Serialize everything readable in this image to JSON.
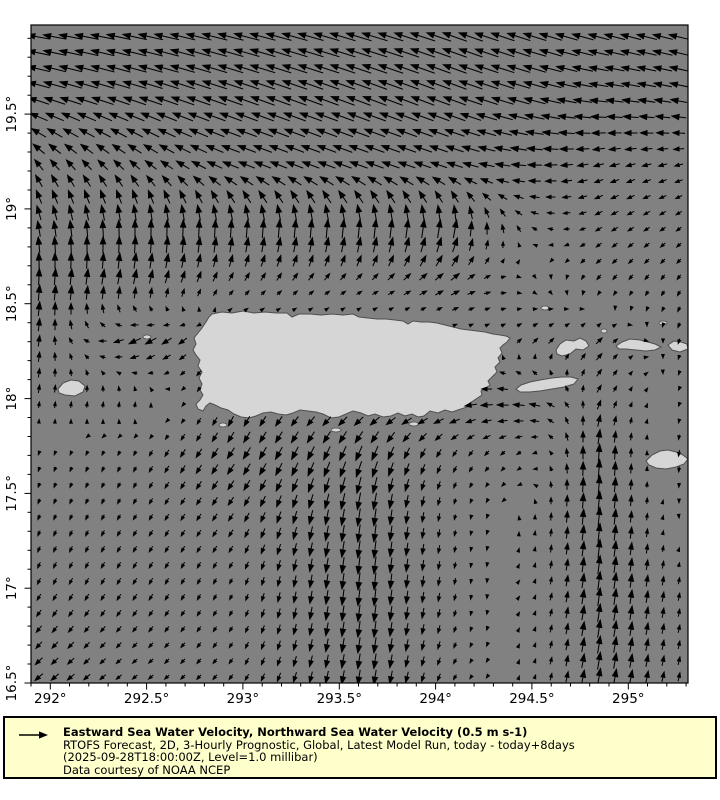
{
  "chart_data": {
    "type": "quiver",
    "description": "Gridded sea-water velocity vector field over Puerto Rico and surrounding Caribbean waters",
    "x_axis": {
      "range": [
        291.9,
        295.31
      ],
      "minor_step": 0.1,
      "major": [
        {
          "label": "292°",
          "value": 292.0
        },
        {
          "label": "292.5°",
          "value": 292.5
        },
        {
          "label": "293°",
          "value": 293.0
        },
        {
          "label": "293.5°",
          "value": 293.5
        },
        {
          "label": "294°",
          "value": 294.0
        },
        {
          "label": "294.5°",
          "value": 294.5
        },
        {
          "label": "295°",
          "value": 295.0
        }
      ]
    },
    "y_axis": {
      "range": [
        16.5,
        19.97
      ],
      "minor_step": 0.1,
      "major": [
        {
          "label": "19.5°",
          "value": 19.5
        },
        {
          "label": "19°",
          "value": 19.0
        },
        {
          "label": "18.5°",
          "value": 18.5
        },
        {
          "label": "18°",
          "value": 18.0
        },
        {
          "label": "17.5°",
          "value": 17.5
        },
        {
          "label": "17°",
          "value": 17.0
        },
        {
          "label": "16.5°",
          "value": 16.5
        }
      ]
    },
    "reference_vector": {
      "speed": 0.5,
      "units": "m s-1"
    },
    "plot_rect": {
      "left": 31,
      "top": 25,
      "right": 688,
      "bottom": 683
    },
    "arrow_grid": {
      "x0": 39,
      "y0": 37,
      "step": 16,
      "cols": 41,
      "rows": 41,
      "px_per_ms": 60
    },
    "colors": {
      "ocean": "#818181",
      "land": "#d6d6d6",
      "coastline": "#4f4f4f",
      "arrow": "#000000",
      "frame": "#000000",
      "legend_bg": "#ffffcc",
      "legend_border": "#000000",
      "page_bg": "#ffffff"
    },
    "field": {
      "units": "m s-1",
      "lons": [
        291.9,
        292.45,
        292.95,
        293.65,
        294.1,
        294.5,
        294.85,
        295.31
      ],
      "lats": [
        19.97,
        19.6,
        19.2,
        18.9,
        18.6,
        18.3,
        18.0,
        17.7,
        17.4,
        17.0,
        16.5
      ],
      "u": [
        [
          -0.38,
          -0.4,
          -0.42,
          -0.42,
          -0.4,
          -0.38,
          -0.35,
          -0.33
        ],
        [
          -0.35,
          -0.38,
          -0.4,
          -0.4,
          -0.38,
          -0.36,
          -0.3,
          -0.28
        ],
        [
          -0.12,
          -0.15,
          -0.25,
          -0.28,
          -0.25,
          -0.22,
          -0.15,
          -0.12
        ],
        [
          -0.05,
          0.0,
          0.02,
          0.03,
          0.05,
          -0.08,
          -0.1,
          -0.08
        ],
        [
          0.02,
          0.06,
          0.08,
          0.1,
          0.15,
          0.05,
          -0.06,
          -0.05
        ],
        [
          0.04,
          -0.2,
          -0.06,
          0.0,
          0.02,
          0.08,
          0.1,
          -0.04
        ],
        [
          0.02,
          0.02,
          -0.06,
          -0.18,
          -0.22,
          -0.2,
          0.06,
          -0.02
        ],
        [
          -0.02,
          -0.04,
          -0.12,
          -0.1,
          -0.06,
          -0.06,
          0.02,
          -0.02
        ],
        [
          -0.03,
          -0.05,
          -0.08,
          -0.04,
          -0.02,
          0.0,
          0.03,
          0.0
        ],
        [
          -0.05,
          -0.06,
          -0.04,
          -0.03,
          -0.02,
          0.02,
          0.04,
          0.02
        ],
        [
          -0.14,
          -0.08,
          -0.06,
          -0.04,
          -0.05,
          0.02,
          0.05,
          0.03
        ]
      ],
      "v": [
        [
          0.06,
          0.08,
          0.1,
          0.12,
          0.14,
          0.12,
          0.1,
          0.08
        ],
        [
          0.1,
          0.12,
          0.14,
          0.15,
          0.14,
          0.1,
          0.04,
          0.06
        ],
        [
          0.18,
          0.15,
          0.1,
          0.1,
          0.08,
          0.0,
          -0.05,
          -0.04
        ],
        [
          0.25,
          0.3,
          0.3,
          0.32,
          0.3,
          0.05,
          -0.06,
          -0.06
        ],
        [
          0.28,
          0.22,
          0.1,
          0.06,
          0.08,
          -0.05,
          -0.08,
          -0.08
        ],
        [
          0.2,
          -0.1,
          -0.1,
          0.0,
          0.0,
          0.08,
          0.1,
          -0.1
        ],
        [
          0.12,
          0.1,
          -0.15,
          -0.06,
          -0.04,
          0.04,
          0.12,
          -0.04
        ],
        [
          -0.06,
          -0.08,
          -0.18,
          -0.25,
          -0.1,
          -0.04,
          0.3,
          -0.15
        ],
        [
          -0.08,
          -0.08,
          -0.12,
          -0.3,
          -0.08,
          0.04,
          0.32,
          -0.08
        ],
        [
          -0.1,
          -0.1,
          -0.08,
          -0.3,
          -0.1,
          0.04,
          0.3,
          0.1
        ],
        [
          -0.12,
          -0.06,
          -0.08,
          -0.25,
          -0.08,
          0.05,
          0.28,
          0.12
        ]
      ]
    }
  },
  "map": {
    "polygons": [
      {
        "name": "puerto-rico",
        "points": [
          [
            212,
            314
          ],
          [
            222,
            312
          ],
          [
            232,
            313
          ],
          [
            243,
            311
          ],
          [
            254,
            313
          ],
          [
            265,
            312
          ],
          [
            276,
            313
          ],
          [
            287,
            313
          ],
          [
            292,
            317
          ],
          [
            299,
            314
          ],
          [
            310,
            314
          ],
          [
            321,
            315
          ],
          [
            332,
            314
          ],
          [
            343,
            315
          ],
          [
            353,
            314
          ],
          [
            359,
            317
          ],
          [
            368,
            318
          ],
          [
            377,
            319
          ],
          [
            386,
            319
          ],
          [
            395,
            320
          ],
          [
            403,
            321
          ],
          [
            408,
            324
          ],
          [
            413,
            321
          ],
          [
            421,
            322
          ],
          [
            429,
            322
          ],
          [
            437,
            323
          ],
          [
            445,
            325
          ],
          [
            453,
            327
          ],
          [
            461,
            329
          ],
          [
            469,
            330
          ],
          [
            477,
            331
          ],
          [
            485,
            332
          ],
          [
            493,
            334
          ],
          [
            500,
            335
          ],
          [
            506,
            336
          ],
          [
            510,
            338
          ],
          [
            507,
            342
          ],
          [
            503,
            345
          ],
          [
            500,
            348
          ],
          [
            502,
            353
          ],
          [
            498,
            358
          ],
          [
            500,
            362
          ],
          [
            495,
            367
          ],
          [
            497,
            372
          ],
          [
            492,
            377
          ],
          [
            488,
            381
          ],
          [
            490,
            385
          ],
          [
            485,
            389
          ],
          [
            481,
            391
          ],
          [
            482,
            395
          ],
          [
            476,
            399
          ],
          [
            470,
            403
          ],
          [
            467,
            407
          ],
          [
            461,
            409
          ],
          [
            452,
            412
          ],
          [
            445,
            410
          ],
          [
            438,
            413
          ],
          [
            430,
            411
          ],
          [
            424,
            416
          ],
          [
            418,
            417
          ],
          [
            412,
            414
          ],
          [
            405,
            416
          ],
          [
            398,
            413
          ],
          [
            391,
            416
          ],
          [
            383,
            417
          ],
          [
            375,
            414
          ],
          [
            368,
            416
          ],
          [
            361,
            413
          ],
          [
            353,
            411
          ],
          [
            346,
            414
          ],
          [
            339,
            417
          ],
          [
            331,
            418
          ],
          [
            323,
            414
          ],
          [
            316,
            412
          ],
          [
            308,
            411
          ],
          [
            300,
            410
          ],
          [
            293,
            413
          ],
          [
            286,
            415
          ],
          [
            278,
            414
          ],
          [
            271,
            412
          ],
          [
            263,
            413
          ],
          [
            256,
            416
          ],
          [
            249,
            418
          ],
          [
            241,
            417
          ],
          [
            234,
            414
          ],
          [
            228,
            410
          ],
          [
            221,
            408
          ],
          [
            215,
            405
          ],
          [
            210,
            403
          ],
          [
            206,
            406
          ],
          [
            203,
            411
          ],
          [
            198,
            409
          ],
          [
            196,
            404
          ],
          [
            200,
            400
          ],
          [
            203,
            395
          ],
          [
            200,
            390
          ],
          [
            202,
            384
          ],
          [
            199,
            378
          ],
          [
            202,
            372
          ],
          [
            198,
            366
          ],
          [
            200,
            360
          ],
          [
            196,
            355
          ],
          [
            193,
            350
          ],
          [
            196,
            344
          ],
          [
            194,
            338
          ],
          [
            198,
            333
          ],
          [
            202,
            328
          ],
          [
            206,
            322
          ],
          [
            209,
            317
          ]
        ]
      },
      {
        "name": "mona",
        "points": [
          [
            58,
            389
          ],
          [
            63,
            383
          ],
          [
            71,
            380
          ],
          [
            79,
            381
          ],
          [
            85,
            386
          ],
          [
            83,
            392
          ],
          [
            75,
            396
          ],
          [
            65,
            395
          ],
          [
            59,
            393
          ]
        ]
      },
      {
        "name": "vieques",
        "points": [
          [
            516,
            389
          ],
          [
            521,
            385
          ],
          [
            530,
            382
          ],
          [
            540,
            380
          ],
          [
            552,
            378
          ],
          [
            562,
            377
          ],
          [
            571,
            377
          ],
          [
            578,
            379
          ],
          [
            574,
            384
          ],
          [
            564,
            387
          ],
          [
            552,
            389
          ],
          [
            540,
            391
          ],
          [
            529,
            392
          ],
          [
            520,
            392
          ]
        ]
      },
      {
        "name": "culebra",
        "points": [
          [
            556,
            350
          ],
          [
            560,
            344
          ],
          [
            566,
            340
          ],
          [
            574,
            341
          ],
          [
            580,
            338
          ],
          [
            586,
            341
          ],
          [
            589,
            346
          ],
          [
            583,
            350
          ],
          [
            576,
            349
          ],
          [
            570,
            354
          ],
          [
            562,
            356
          ],
          [
            557,
            354
          ]
        ]
      },
      {
        "name": "st-thomas",
        "points": [
          [
            616,
            346
          ],
          [
            622,
            342
          ],
          [
            630,
            339
          ],
          [
            640,
            340
          ],
          [
            648,
            342
          ],
          [
            655,
            344
          ],
          [
            661,
            347
          ],
          [
            655,
            350
          ],
          [
            646,
            351
          ],
          [
            636,
            350
          ],
          [
            626,
            349
          ],
          [
            619,
            349
          ]
        ]
      },
      {
        "name": "st-john",
        "points": [
          [
            668,
            345
          ],
          [
            674,
            341
          ],
          [
            681,
            342
          ],
          [
            687,
            344
          ],
          [
            688,
            349
          ],
          [
            680,
            352
          ],
          [
            672,
            350
          ]
        ]
      },
      {
        "name": "st-croix",
        "points": [
          [
            646,
            461
          ],
          [
            652,
            455
          ],
          [
            660,
            451
          ],
          [
            668,
            450
          ],
          [
            676,
            452
          ],
          [
            683,
            455
          ],
          [
            688,
            459
          ],
          [
            684,
            464
          ],
          [
            676,
            467
          ],
          [
            666,
            469
          ],
          [
            656,
            468
          ],
          [
            649,
            465
          ]
        ]
      }
    ],
    "islets": [
      {
        "name": "desecheo",
        "cx": 147,
        "cy": 337,
        "rx": 4,
        "ry": 2
      },
      {
        "name": "islet-south-1",
        "cx": 223,
        "cy": 425,
        "rx": 4,
        "ry": 2
      },
      {
        "name": "caja-de-muertos",
        "cx": 336,
        "cy": 430,
        "rx": 5,
        "ry": 2
      },
      {
        "name": "islet-south-2",
        "cx": 414,
        "cy": 424,
        "rx": 5,
        "ry": 2
      },
      {
        "name": "islet-ne-1",
        "cx": 663,
        "cy": 323,
        "rx": 4,
        "ry": 2
      },
      {
        "name": "islet-ne-2",
        "cx": 604,
        "cy": 331,
        "rx": 3,
        "ry": 2
      },
      {
        "name": "islet-e",
        "cx": 545,
        "cy": 308,
        "rx": 4,
        "ry": 2
      }
    ]
  },
  "legend": {
    "title": "Eastward Sea Water Velocity, Northward Sea Water Velocity (0.5 m s-1)",
    "line2": "RTOFS Forecast, 2D, 3-Hourly Prognostic, Global, Latest Model Run, today - today+8days",
    "line3": "(2025-09-28T18:00:00Z, Level=1.0 millibar)",
    "line4": "Data courtesy of NOAA NCEP"
  }
}
